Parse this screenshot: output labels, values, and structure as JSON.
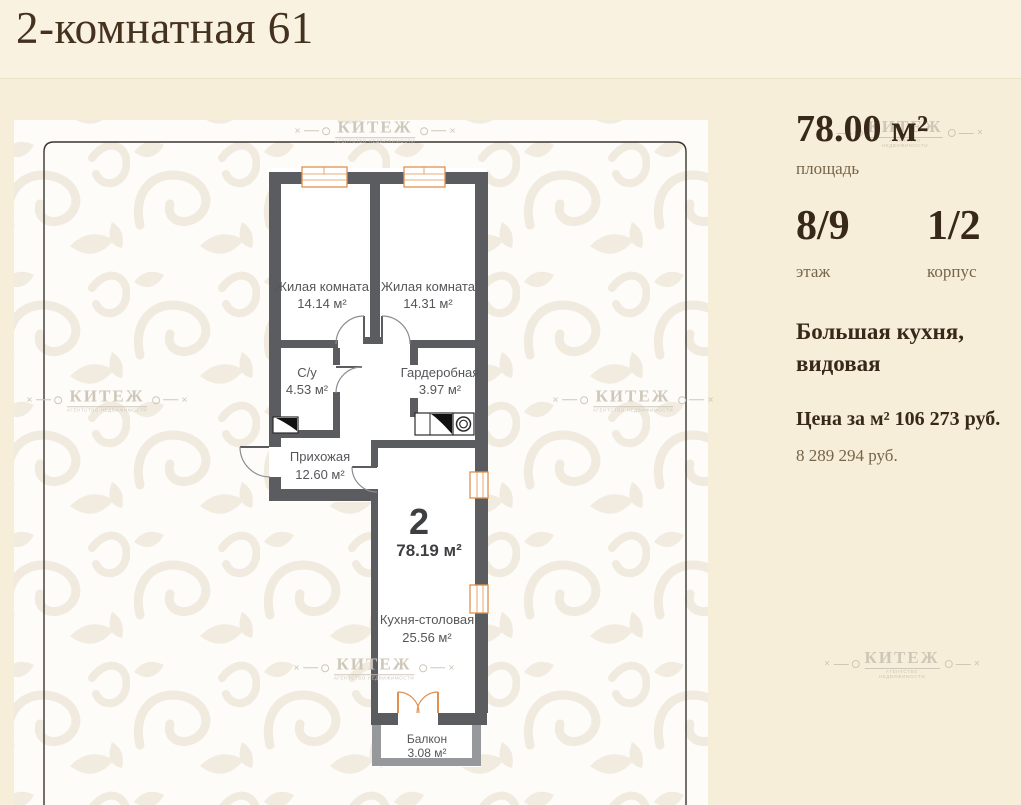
{
  "page": {
    "title": "2-комнатная 61"
  },
  "watermark": {
    "title": "КИТЕЖ",
    "subtitle": "АГЕНТСТВО НЕДВИЖИМОСТИ"
  },
  "details": {
    "area_value": "78.00 м²",
    "area_label": "площадь",
    "floor_value": "8/9",
    "floor_label": "этаж",
    "building_value": "1/2",
    "building_label": "корпус",
    "feature": "Большая кухня, видовая",
    "price_per_m2": "Цена за м² 106 273 руб.",
    "total_price": "8 289 294 руб."
  },
  "plan": {
    "number": "2",
    "total_area": "78.19 м²",
    "rooms": [
      {
        "name": "Жилая комната",
        "area": "14.14 м²"
      },
      {
        "name": "Жилая комната",
        "area": "14.31 м²"
      },
      {
        "name": "С/у",
        "area": "4.53 м²"
      },
      {
        "name": "Гардеробная",
        "area": "3.97 м²"
      },
      {
        "name": "Прихожая",
        "area": "12.60 м²"
      },
      {
        "name": "Кухня-столовая",
        "area": "25.56 м²"
      },
      {
        "name": "Балкон",
        "area": "3.08 м²"
      }
    ]
  },
  "colors": {
    "background": "#f6eed8",
    "wall": "#5b5c5f",
    "window_accent": "#e0914f",
    "text_dark": "#38281a",
    "text_muted": "#77654a"
  }
}
